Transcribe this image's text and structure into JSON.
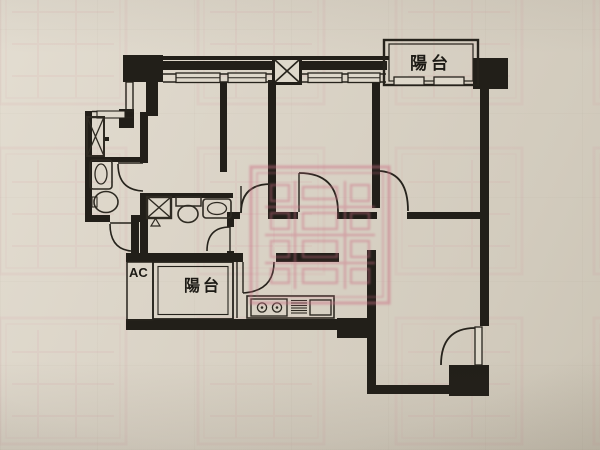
{
  "document": {
    "kind": "floor-plan-photo",
    "description": "Black ink apartment floor plan printed on beige paper, photographed; a pink rectangular realtor seal watermark is stamped over the center and tiles faintly across the page"
  },
  "plan": {
    "labels": {
      "balcony_top": "陽台",
      "balcony_bottom": "陽台",
      "ac_shaft": "AC"
    },
    "symbols": [
      "duct-x-icon",
      "window-sill-symbol",
      "door-arc-symbol",
      "toilet-symbol",
      "sink-symbol",
      "stove-symbol",
      "grill-vent-symbol",
      "kitchen-sink-symbol",
      "shower-triangle-symbol"
    ]
  },
  "watermark": {
    "style": "rectangular double-border seal with illegible CJK strokes",
    "color": "#d2798c"
  },
  "colors": {
    "paper": "#dad3c6",
    "ink": "#221f19",
    "watermark_pink": "#d2798c"
  }
}
